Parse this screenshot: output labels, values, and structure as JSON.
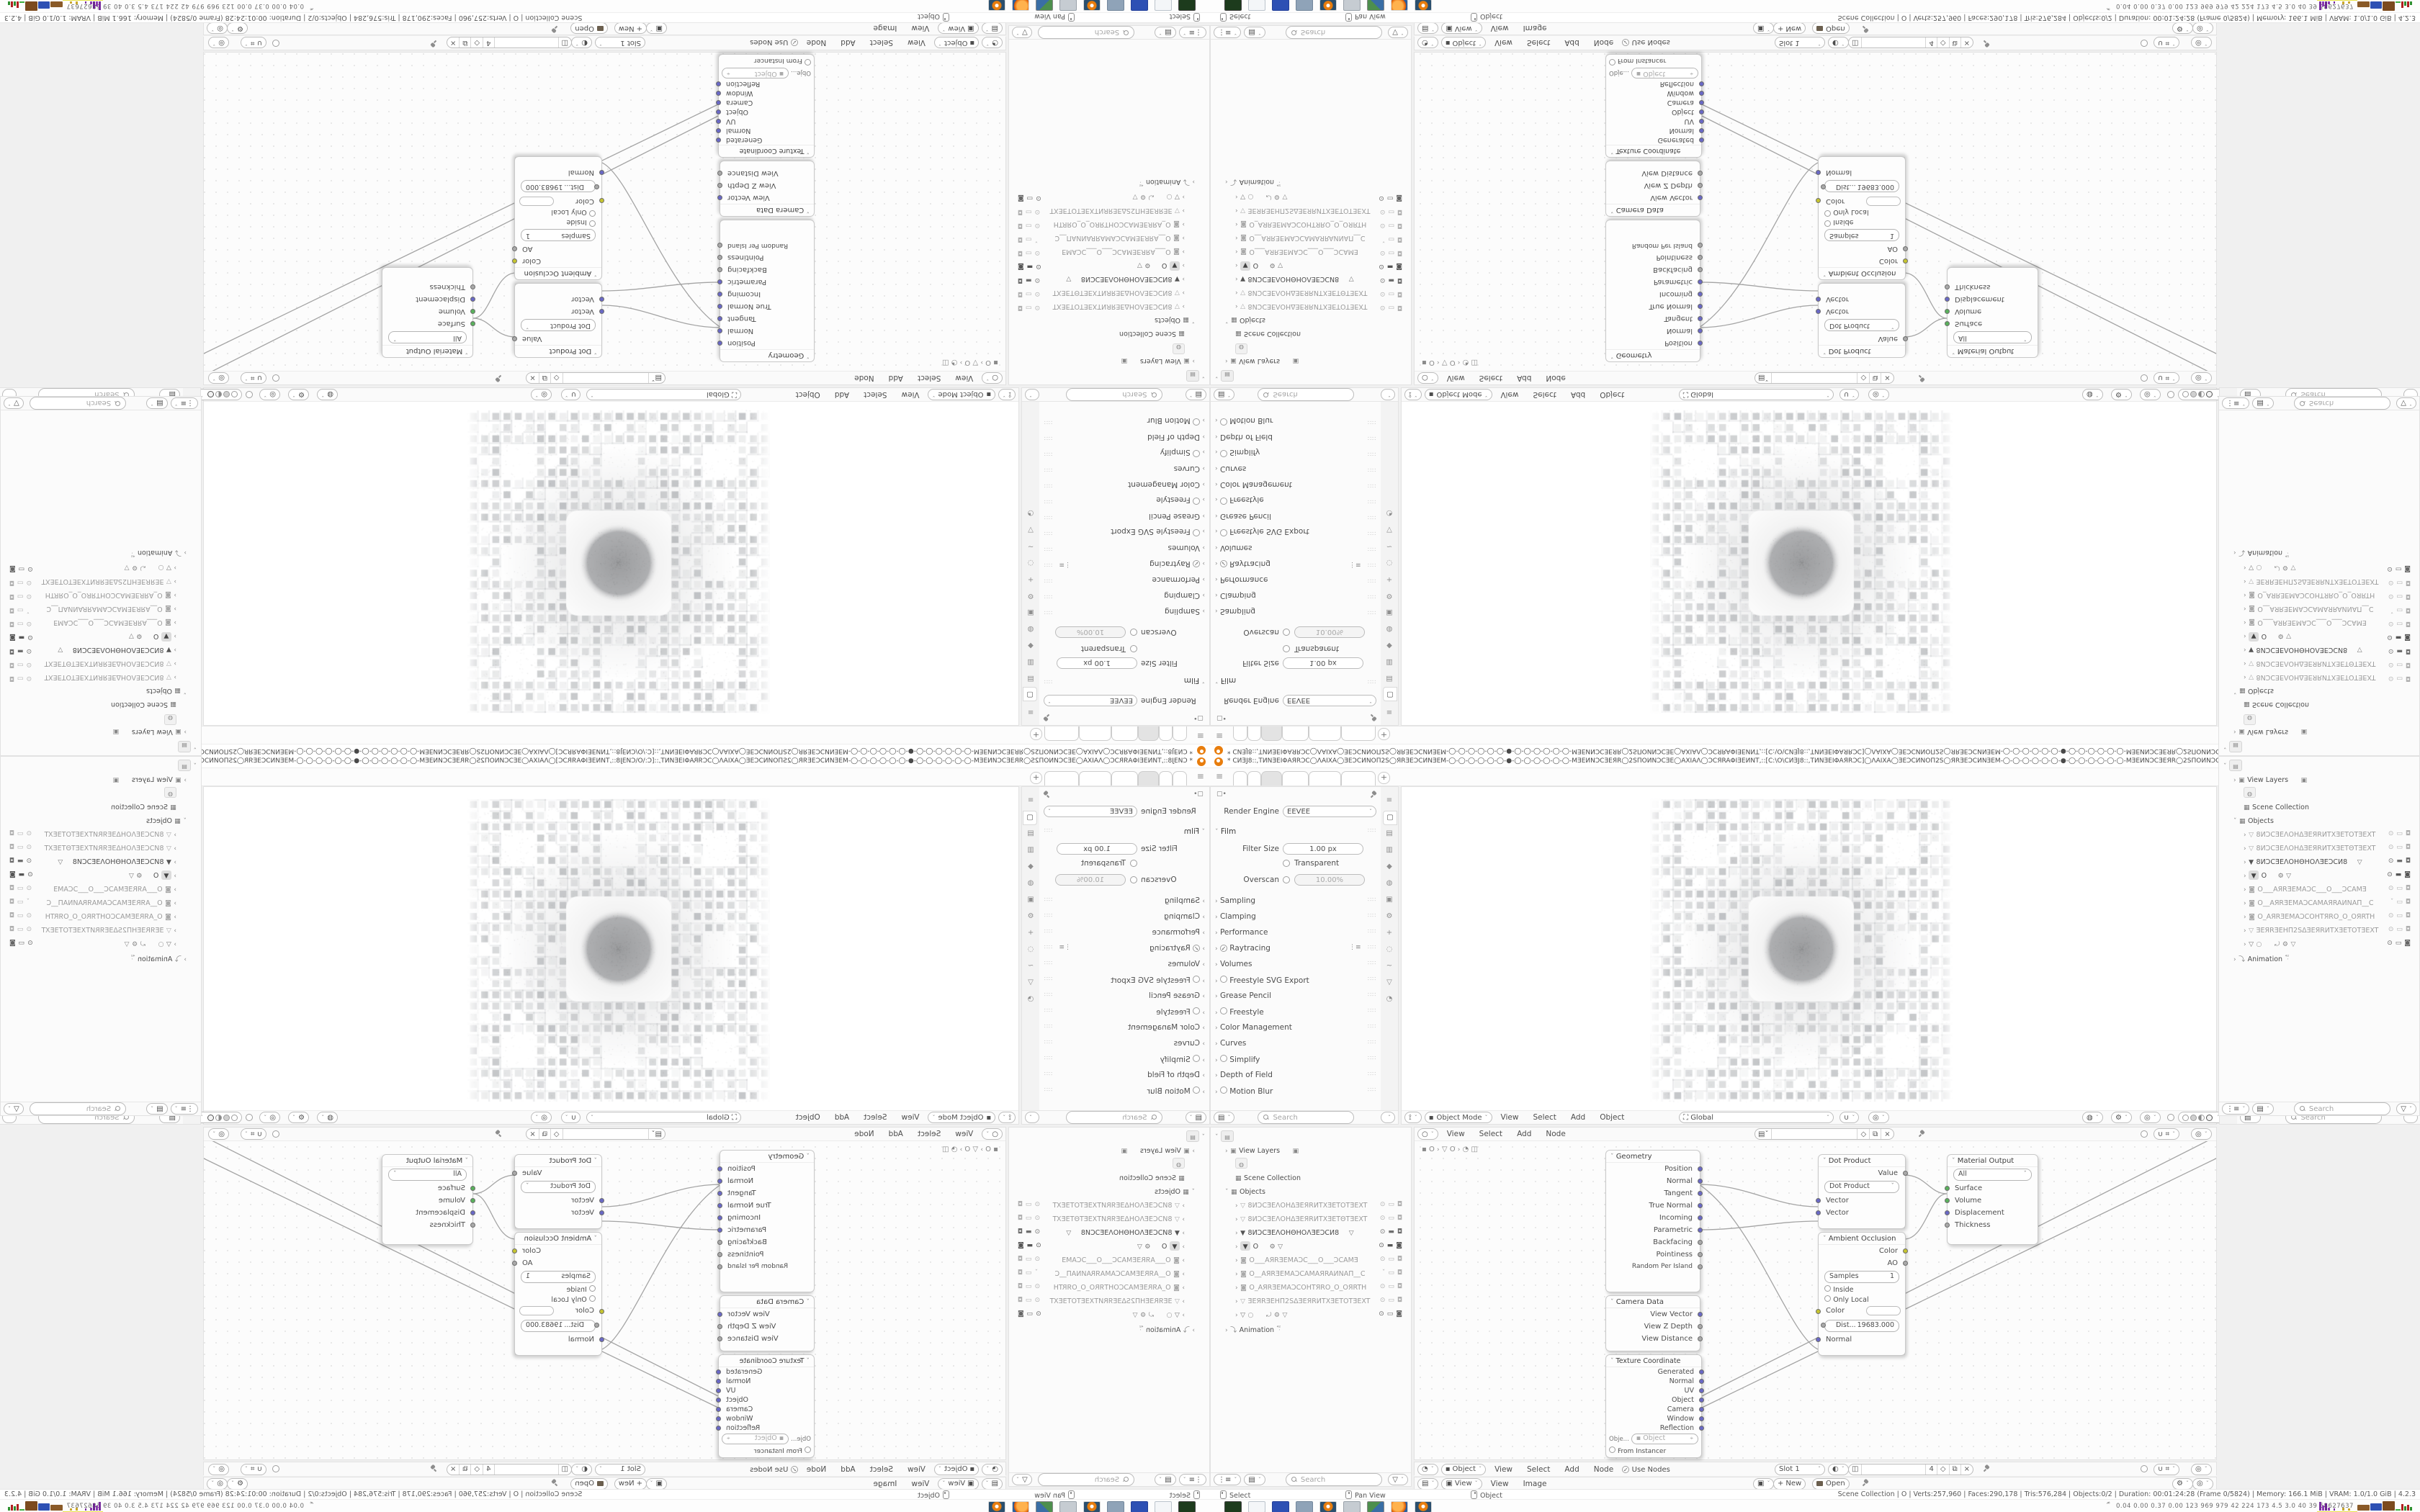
{
  "window": {
    "title": "* СИƎJ8::,TИNƎEIΦAЯRϽC◯ΛAIXA◯ƎEϽCИNOΠ2S◯ЯRƎEϽCИNƎEM-◯-◯-◯-◯-◯-◯-●-◯-◯-◯-◯-◯-◯-MƎEИNϽCƎEЯR◯2SΠOИNϽCƎE◯AXIAΛ◯ϽCЯRAΦIƎEИNT,::[C:\\O\\СИƎJ8::,TИNƎEIΦAЯRϽC]◯ΛAIXA◯ƎEϽCИNOΠ2S◯ЯRƎEϽCИNƎEM-◯-◯-◯-◯-◯-◯-●-◯-◯-◯-◯-◯-◯-MƎEИNϽCƎEЯR◯2SΠOИNϽCƎE◯AXIAΛ◯ϽCЯRAΦIƎEИNT.",
    "minimize": "─",
    "restore": "⧉",
    "close": "×"
  },
  "colors": {
    "accent_orange": "#e87d0d",
    "socket_vector": "#6968c6",
    "socket_shader": "#59b15c",
    "socket_color": "#c6c52f",
    "socket_value": "#a9a9a9"
  },
  "props_left": {
    "engine_label": "Render Engine",
    "engine_value": "EEVEE",
    "film": "Film",
    "filter_size_label": "Filter Size",
    "filter_size_value": "1.00 px",
    "transparent": "Transparent",
    "overscan_label": "Overscan",
    "overscan_value": "10.00%",
    "panels": [
      {
        "label": "Sampling"
      },
      {
        "label": "Clamping"
      },
      {
        "label": "Performance"
      },
      {
        "label": "Raytracing"
      },
      {
        "label": "Volumes"
      },
      {
        "label": "Freestyle SVG Export"
      },
      {
        "label": "Grease Pencil"
      },
      {
        "label": "Freestyle"
      },
      {
        "label": "Color Management"
      },
      {
        "label": "Curves"
      },
      {
        "label": "Simplify"
      },
      {
        "label": "Depth of Field"
      },
      {
        "label": "Motion Blur"
      }
    ],
    "search_placeholder": "Search"
  },
  "props_right": {
    "breadcrumb_obj": "O",
    "breadcrumb_data": "O",
    "datablock_name": "O",
    "datablock_users": "2",
    "tissue": "Tissue Tessellate",
    "vertex_groups": "Vertex Groups",
    "shape_keys": "Shape Keys",
    "add_rest_position": "Add Rest Position",
    "uv_maps": "UV Maps",
    "color_attributes": "Color Attributes",
    "search_placeholder": "Search"
  },
  "viewport": {
    "mode": "Object Mode",
    "menu_view": "View",
    "menu_select": "Select",
    "menu_add": "Add",
    "menu_object": "Object",
    "orientation": "Global"
  },
  "shader1": {
    "menu_view": "View",
    "menu_select": "Select",
    "menu_add": "Add",
    "menu_node": "Node",
    "breadcrumb_obj": "O",
    "breadcrumb_data": "O"
  },
  "shader2": {
    "type": "Object",
    "menu_view": "View",
    "menu_select": "Select",
    "menu_add": "Add",
    "menu_node": "Node",
    "use_nodes": "Use Nodes",
    "slot": "Slot 1",
    "mat_users": "4"
  },
  "image_editor": {
    "mode": "View",
    "menu_view": "View",
    "menu_image": "Image",
    "new_label": "New",
    "open_label": "Open"
  },
  "nodes": {
    "geometry": {
      "title": "Geometry",
      "outputs": [
        "Position",
        "Normal",
        "Tangent",
        "True Normal",
        "Incoming",
        "Parametric",
        "Backfacing",
        "Pointiness",
        "Random Per Island"
      ]
    },
    "camera_data": {
      "title": "Camera Data",
      "outputs": [
        "View Vector",
        "View Z Depth",
        "View Distance"
      ]
    },
    "texcoord": {
      "title": "Texture Coordinate",
      "outputs": [
        "Generated",
        "Normal",
        "UV",
        "Object",
        "Camera",
        "Window",
        "Reflection"
      ],
      "object_label": "Obje...",
      "object_value": "Object",
      "from_instancer": "From Instancer"
    },
    "dot_product": {
      "title": "Dot Product",
      "value_label": "Value",
      "op": "Dot Product",
      "input1": "Vector",
      "input2": "Vector"
    },
    "material_output": {
      "title": "Material Output",
      "target": "All",
      "inputs": [
        "Surface",
        "Volume",
        "Displacement",
        "Thickness"
      ]
    },
    "ao": {
      "title": "Ambient Occlusion",
      "out_color": "Color",
      "out_ao": "AO",
      "samples_label": "Samples",
      "samples_value": "1",
      "inside": "Inside",
      "only_local": "Only Local",
      "in_color": "Color",
      "dist_label": "Dist...",
      "dist_value": "19683.000",
      "in_normal": "Normal"
    }
  },
  "outliner": {
    "view_layers": "View Layers",
    "scene_collection": "Scene Collection",
    "objects_label": "Objects",
    "objects": [
      {
        "name": "8ИϽCƎEΛOHΔƎEЯRИTXƎETOTƎEXT"
      },
      {
        "name": "8ИϽCƎEΛOHΔƎEЯRИTXƎETΘTƎEXT"
      },
      {
        "name": "8ИϽCƎEΛOHΘHOΛƎEϽCИ8"
      },
      {
        "name": "O"
      },
      {
        "name": "O___AЯRƎEMAϽC___O___ϽCAMƎ"
      },
      {
        "name": "O__AЯRƎEMAϽCAMAЯRAИNAΠ__C"
      },
      {
        "name": "O_AЯRƎEMAϽCOHTЯRO_O_OЯRTH"
      },
      {
        "name": "ƎEЯRƎEHΠ2SΔƎEЯRИTXƎETOTƎEXT"
      }
    ],
    "animation": "Animation",
    "search_placeholder": "Search"
  },
  "status_bar": {
    "hint_left": "Select",
    "hint_middle": "Pan View",
    "hint_right": "Object",
    "stats": "Scene Collection | O | Verts:257,960 | Faces:290,178 | Tris:576,284 | Objects:0/2 | Duration: 00:01:24:28 (Frame 0/5824) | Memory: 166.1 MiB | VRAM: 1.0/1.0 GiB | 4.2.3"
  },
  "taskbar": {
    "sysmon": "0.04 0.00 0.37 0.00 123 969 979 42 224 173 4.5 3.0 40 39 58627637"
  }
}
